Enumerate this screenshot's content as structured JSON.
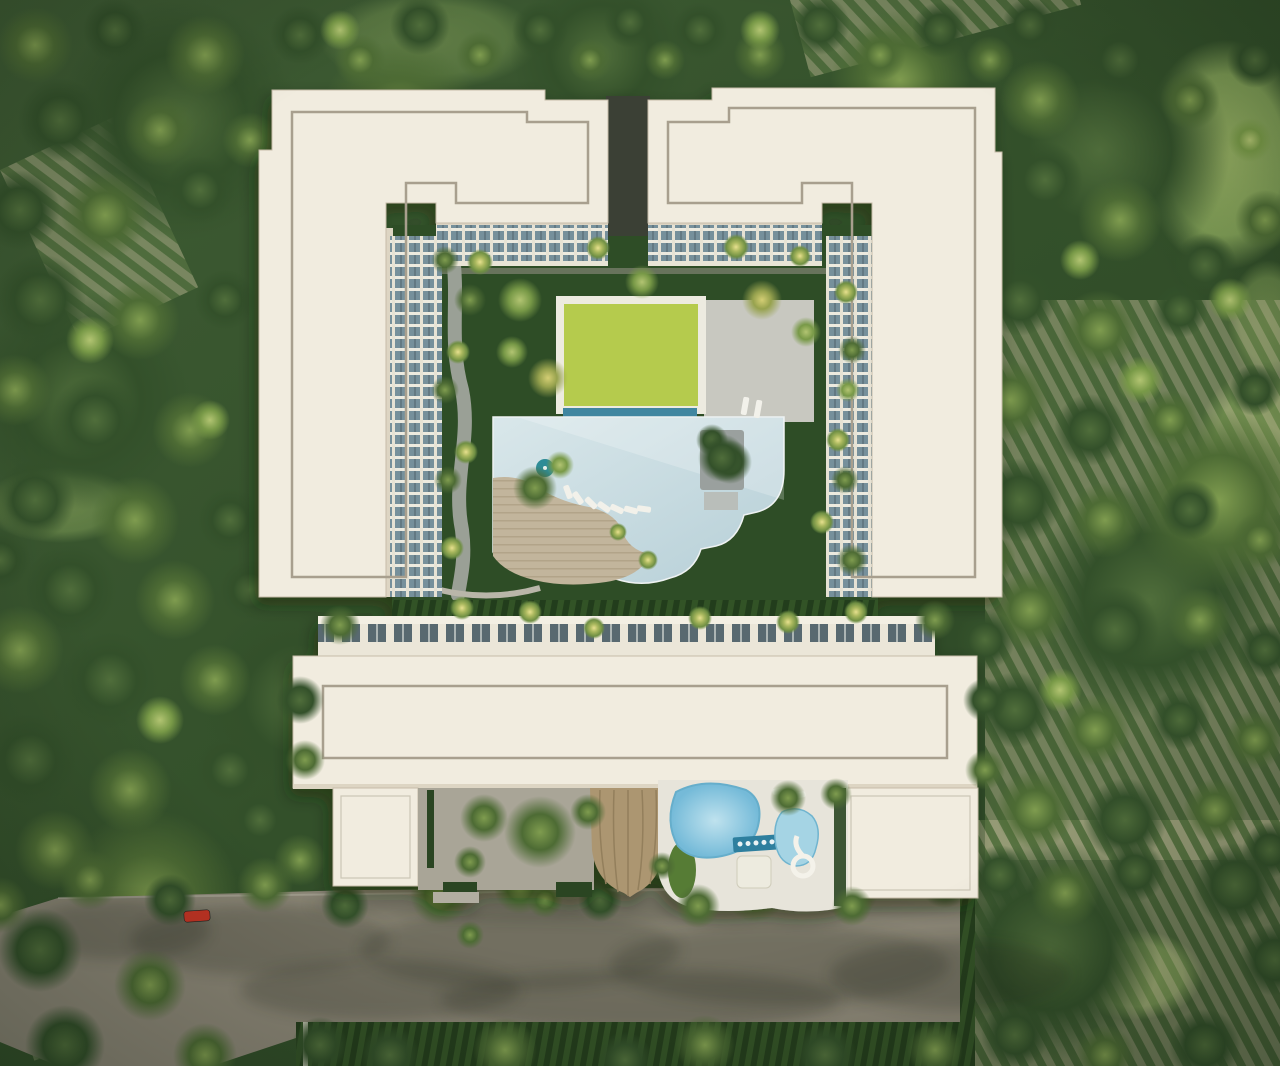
{
  "meta": {
    "description": "Aerial top-down architectural render of a white condominium complex with central courtyard, lap pool, lime lawn, kids pool with slide, parking street with cars, surrounded by dense forest and orchard rows",
    "image_kind": "3d-architectural-render"
  },
  "palette": {
    "forestA": "#3c5832",
    "forestB": "#2b4424",
    "meadow": "#a4bd6b",
    "orchardStripe": "#b7b68f",
    "orchardGreen": "#6d8a4f",
    "road": "#8b8676",
    "curb": "#b5b1a3",
    "hedgeA": "#335226",
    "hedgeB": "#243d1c",
    "hedge": "#2b4522",
    "roof": "#f1ecdf",
    "roofShade": "#ddd5c3",
    "roofLine": "#a89f8e",
    "facadeCream": "#ece7d9",
    "glass": "#76909b",
    "glassDark": "#59696f",
    "lawn": "#2f4e27",
    "lime": "#b5cb4d",
    "limeFrame": "#edebe0",
    "poolA": "#d9e7ea",
    "poolB": "#b6cfd7",
    "poolEdge": "#3f86a0",
    "deck": "#c2b59c",
    "deckDark": "#b2a489",
    "path": "#9aa096",
    "paving": "#a9a597",
    "wall": "#d6d3c6",
    "kidPoolA": "#bfe2ee",
    "kidPoolB": "#74bad8",
    "kidPoolDeep": "#2e7f9e",
    "deckWhite": "#e7e4da",
    "canopyRoof": "#ac9671",
    "canopyRib": "#937f5c",
    "driveway": "#3a3f35",
    "lounger": "#f2f1ea",
    "carWhite": "#ecece8",
    "carDark": "#30363a",
    "carRed": "#c23424",
    "island": "#9aa09e",
    "umbrella": "#2f8c96"
  },
  "scene": {
    "site_label": "condominium-aerial-view",
    "meadows": [
      [
        1225,
        155,
        85,
        115,
        0.85
      ],
      [
        1258,
        448,
        62,
        78,
        0.7
      ],
      [
        1135,
        975,
        68,
        45,
        0.8
      ],
      [
        60,
        505,
        78,
        38,
        0.45
      ],
      [
        1268,
        320,
        40,
        60,
        0.5
      ],
      [
        430,
        40,
        110,
        50,
        0.35
      ]
    ],
    "orchards": [
      [
        985,
        300,
        300,
        560,
        0
      ],
      [
        975,
        820,
        305,
        246,
        0
      ],
      [
        0,
        955,
        190,
        111,
        -18
      ],
      [
        0,
        170,
        130,
        190,
        -25
      ],
      [
        790,
        0,
        280,
        80,
        -15
      ]
    ],
    "road_shadows": [
      [
        260,
        940,
        130,
        35
      ],
      [
        520,
        950,
        160,
        40
      ],
      [
        780,
        965,
        170,
        40
      ],
      [
        120,
        930,
        90,
        30
      ],
      [
        950,
        975,
        120,
        35
      ],
      [
        640,
        1000,
        200,
        30
      ],
      [
        380,
        990,
        140,
        30
      ],
      [
        640,
        905,
        330,
        16
      ]
    ],
    "trees": {
      "bg": [
        [
          180,
          120,
          120,
          "dark"
        ],
        [
          80,
          400,
          110,
          "dark"
        ],
        [
          1100,
          150,
          130,
          "dark"
        ],
        [
          1150,
          600,
          120,
          "dark"
        ],
        [
          300,
          700,
          100,
          "dark"
        ],
        [
          1050,
          950,
          110,
          "dark"
        ],
        [
          600,
          55,
          90,
          "dark"
        ],
        [
          400,
          120,
          80,
          "mid"
        ],
        [
          900,
          80,
          70,
          "mid"
        ],
        [
          1220,
          500,
          90,
          "mid"
        ],
        [
          150,
          900,
          90,
          "mid"
        ],
        [
          35,
          45,
          38,
          "mid"
        ],
        [
          115,
          30,
          32,
          "dark"
        ],
        [
          205,
          55,
          40,
          "mid"
        ],
        [
          60,
          120,
          42,
          "dark"
        ],
        [
          160,
          130,
          36,
          "mid"
        ],
        [
          20,
          210,
          40,
          "dark"
        ],
        [
          105,
          215,
          44,
          "mid"
        ],
        [
          200,
          190,
          34,
          "dark"
        ],
        [
          250,
          140,
          28,
          "mid"
        ],
        [
          40,
          300,
          46,
          "dark"
        ],
        [
          140,
          320,
          40,
          "mid"
        ],
        [
          225,
          300,
          30,
          "dark"
        ],
        [
          15,
          390,
          36,
          "mid"
        ],
        [
          95,
          420,
          44,
          "dark"
        ],
        [
          190,
          430,
          38,
          "mid"
        ],
        [
          35,
          500,
          40,
          "dark"
        ],
        [
          135,
          520,
          44,
          "mid"
        ],
        [
          230,
          520,
          32,
          "dark"
        ],
        [
          70,
          590,
          46,
          "dark"
        ],
        [
          175,
          600,
          40,
          "mid"
        ],
        [
          250,
          590,
          30,
          "dark"
        ],
        [
          20,
          650,
          44,
          "mid"
        ],
        [
          110,
          680,
          48,
          "dark"
        ],
        [
          215,
          680,
          36,
          "mid"
        ],
        [
          30,
          760,
          46,
          "dark"
        ],
        [
          130,
          790,
          42,
          "mid"
        ],
        [
          230,
          770,
          34,
          "dark"
        ],
        [
          55,
          850,
          40,
          "mid"
        ],
        [
          0,
          560,
          30,
          "dark"
        ],
        [
          260,
          820,
          30,
          "dark"
        ],
        [
          300,
          860,
          26,
          "mid"
        ],
        [
          300,
          35,
          30,
          "dark"
        ],
        [
          360,
          60,
          26,
          "mid"
        ],
        [
          420,
          25,
          30,
          "dark"
        ],
        [
          480,
          55,
          24,
          "mid"
        ],
        [
          540,
          30,
          28,
          "dark"
        ],
        [
          590,
          60,
          22,
          "mid"
        ],
        [
          630,
          22,
          26,
          "dark"
        ],
        [
          665,
          60,
          20,
          "mid"
        ],
        [
          700,
          30,
          28,
          "dark"
        ],
        [
          760,
          55,
          26,
          "mid"
        ],
        [
          820,
          25,
          30,
          "dark"
        ],
        [
          880,
          55,
          26,
          "mid"
        ],
        [
          940,
          30,
          28,
          "dark"
        ],
        [
          990,
          60,
          24,
          "mid"
        ],
        [
          1030,
          25,
          28,
          "dark"
        ],
        [
          628,
          120,
          16,
          "dark"
        ],
        [
          628,
          175,
          14,
          "dark"
        ],
        [
          630,
          215,
          12,
          "mid"
        ],
        [
          1040,
          100,
          40,
          "mid"
        ],
        [
          1120,
          60,
          34,
          "dark"
        ],
        [
          1190,
          100,
          30,
          "mid"
        ],
        [
          1255,
          60,
          28,
          "dark"
        ],
        [
          1045,
          180,
          38,
          "dark"
        ],
        [
          1120,
          220,
          42,
          "mid"
        ],
        [
          1205,
          265,
          32,
          "dark"
        ],
        [
          1265,
          220,
          30,
          "mid"
        ],
        [
          1020,
          300,
          36,
          "dark"
        ],
        [
          1100,
          330,
          40,
          "mid"
        ],
        [
          1180,
          310,
          28,
          "dark"
        ],
        [
          1010,
          400,
          40,
          "mid"
        ],
        [
          1090,
          430,
          36,
          "dark"
        ],
        [
          1170,
          420,
          30,
          "mid"
        ],
        [
          1255,
          390,
          26,
          "dark"
        ],
        [
          1020,
          500,
          42,
          "dark"
        ],
        [
          1105,
          520,
          38,
          "mid"
        ],
        [
          1190,
          510,
          30,
          "dark"
        ],
        [
          1260,
          540,
          28,
          "mid"
        ],
        [
          1030,
          610,
          40,
          "mid"
        ],
        [
          1115,
          630,
          44,
          "dark"
        ],
        [
          1200,
          620,
          32,
          "mid"
        ],
        [
          1265,
          650,
          28,
          "dark"
        ],
        [
          1015,
          710,
          38,
          "dark"
        ],
        [
          1095,
          730,
          36,
          "mid"
        ],
        [
          1180,
          720,
          30,
          "dark"
        ],
        [
          1255,
          740,
          30,
          "mid"
        ],
        [
          1035,
          810,
          40,
          "mid"
        ],
        [
          1125,
          820,
          42,
          "dark"
        ],
        [
          1215,
          810,
          32,
          "mid"
        ],
        [
          1270,
          850,
          28,
          "dark"
        ],
        [
          985,
          640,
          30,
          "dark"
        ],
        [
          990,
          560,
          26,
          "mid"
        ],
        [
          90,
          340,
          24,
          "light"
        ],
        [
          210,
          420,
          20,
          "light"
        ],
        [
          1140,
          380,
          24,
          "light"
        ],
        [
          1060,
          690,
          22,
          "light"
        ],
        [
          1230,
          300,
          22,
          "light"
        ],
        [
          160,
          720,
          24,
          "light"
        ],
        [
          340,
          30,
          20,
          "light"
        ],
        [
          760,
          30,
          20,
          "light"
        ],
        [
          1250,
          140,
          22,
          "light"
        ],
        [
          1080,
          260,
          20,
          "light"
        ]
      ],
      "road": [
        [
          90,
          880,
          30,
          "mid"
        ],
        [
          170,
          900,
          26,
          "dark"
        ],
        [
          265,
          885,
          28,
          "mid"
        ],
        [
          345,
          905,
          24,
          "dark"
        ],
        [
          440,
          895,
          30,
          "mid"
        ],
        [
          520,
          888,
          26,
          "mid"
        ],
        [
          600,
          900,
          22,
          "dark"
        ],
        [
          755,
          890,
          32,
          "mid"
        ],
        [
          850,
          892,
          28,
          "mid"
        ],
        [
          945,
          882,
          26,
          "dark"
        ],
        [
          1000,
          875,
          30,
          "dark"
        ],
        [
          1065,
          893,
          34,
          "mid"
        ],
        [
          1135,
          872,
          30,
          "dark"
        ],
        [
          1235,
          885,
          42,
          "dark"
        ],
        [
          1275,
          960,
          36,
          "dark"
        ],
        [
          40,
          950,
          42,
          "dark"
        ],
        [
          150,
          985,
          36,
          "mid"
        ],
        [
          65,
          1045,
          40,
          "dark"
        ],
        [
          205,
          1055,
          32,
          "mid"
        ],
        [
          320,
          1045,
          28,
          "dark"
        ],
        [
          0,
          905,
          28,
          "mid"
        ],
        [
          390,
          1055,
          30,
          "dark"
        ],
        [
          505,
          1050,
          32,
          "mid"
        ],
        [
          625,
          1060,
          28,
          "dark"
        ],
        [
          705,
          1045,
          30,
          "mid"
        ],
        [
          825,
          1055,
          32,
          "dark"
        ],
        [
          935,
          1050,
          28,
          "mid"
        ],
        [
          1015,
          1035,
          34,
          "dark"
        ],
        [
          1105,
          1055,
          30,
          "mid"
        ],
        [
          1205,
          1045,
          36,
          "dark"
        ],
        [
          470,
          935,
          14,
          "mid"
        ],
        [
          545,
          900,
          18,
          "mid"
        ]
      ],
      "fg": [
        [
          480,
          262,
          13,
          "palm"
        ],
        [
          598,
          248,
          12,
          "palm"
        ],
        [
          736,
          247,
          13,
          "palm"
        ],
        [
          800,
          256,
          11,
          "palm"
        ],
        [
          846,
          292,
          12,
          "palm"
        ],
        [
          458,
          352,
          12,
          "palm"
        ],
        [
          466,
          452,
          12,
          "palm"
        ],
        [
          452,
          548,
          12,
          "palm"
        ],
        [
          462,
          608,
          12,
          "palm"
        ],
        [
          530,
          612,
          12,
          "palm"
        ],
        [
          594,
          628,
          11,
          "palm"
        ],
        [
          700,
          618,
          12,
          "palm"
        ],
        [
          788,
          622,
          12,
          "palm"
        ],
        [
          856,
          612,
          12,
          "palm"
        ],
        [
          838,
          440,
          12,
          "palm"
        ],
        [
          822,
          522,
          12,
          "palm"
        ],
        [
          648,
          560,
          10,
          "palm"
        ],
        [
          618,
          532,
          9,
          "palm"
        ],
        [
          520,
          300,
          22,
          "light"
        ],
        [
          548,
          378,
          20,
          "yellow"
        ],
        [
          512,
          352,
          16,
          "light"
        ],
        [
          642,
          282,
          17,
          "light"
        ],
        [
          762,
          300,
          20,
          "yellow"
        ],
        [
          806,
          332,
          15,
          "light"
        ],
        [
          730,
          462,
          22,
          "dark"
        ],
        [
          535,
          488,
          22,
          "mid"
        ],
        [
          560,
          465,
          14,
          "light"
        ],
        [
          470,
          300,
          16,
          "mid"
        ],
        [
          445,
          390,
          14,
          "mid"
        ],
        [
          448,
          480,
          14,
          "mid"
        ],
        [
          445,
          260,
          14,
          "mid"
        ],
        [
          852,
          350,
          14,
          "mid"
        ],
        [
          848,
          390,
          12,
          "light"
        ],
        [
          845,
          480,
          14,
          "mid"
        ],
        [
          852,
          560,
          16,
          "mid"
        ],
        [
          712,
          440,
          16,
          "dark"
        ],
        [
          722,
          458,
          24,
          "dark"
        ],
        [
          540,
          832,
          36,
          "mid"
        ],
        [
          484,
          818,
          24,
          "mid"
        ],
        [
          588,
          812,
          18,
          "mid"
        ],
        [
          470,
          862,
          16,
          "mid"
        ],
        [
          698,
          906,
          22,
          "mid"
        ],
        [
          788,
          798,
          18,
          "mid"
        ],
        [
          836,
          794,
          16,
          "mid"
        ],
        [
          662,
          866,
          14,
          "mid"
        ],
        [
          852,
          906,
          20,
          "mid"
        ],
        [
          300,
          700,
          24,
          "dark"
        ],
        [
          305,
          760,
          20,
          "mid"
        ],
        [
          985,
          700,
          22,
          "dark"
        ],
        [
          985,
          770,
          20,
          "mid"
        ],
        [
          340,
          625,
          20,
          "mid"
        ],
        [
          935,
          620,
          20,
          "mid"
        ]
      ]
    },
    "loungers": [
      [
        568,
        492,
        -20,
        14
      ],
      [
        578,
        498,
        -35,
        14
      ],
      [
        591,
        503,
        -45,
        14
      ],
      [
        604,
        507,
        -55,
        14
      ],
      [
        617,
        509,
        -65,
        14
      ],
      [
        631,
        510,
        -75,
        14
      ],
      [
        644,
        509,
        -82,
        14
      ],
      [
        745,
        406,
        10,
        18
      ],
      [
        758,
        409,
        10,
        18
      ],
      [
        779,
        791,
        80,
        13
      ],
      [
        789,
        793,
        80,
        13
      ],
      [
        799,
        795,
        80,
        13
      ]
    ],
    "cars": [
      {
        "x": 197,
        "y": 916,
        "w": 26,
        "h": 11,
        "rot": -4,
        "color": "carRed"
      },
      {
        "x": 57,
        "y": 974,
        "w": 24,
        "h": 11,
        "rot": 3,
        "color": "carWhite"
      },
      {
        "x": 352,
        "y": 991,
        "w": 24,
        "h": 11,
        "rot": -2,
        "color": "carWhite"
      },
      {
        "x": 248,
        "y": 1032,
        "w": 11,
        "h": 24,
        "rot": 0,
        "color": "carWhite"
      },
      {
        "x": 640,
        "y": 937,
        "w": 24,
        "h": 11,
        "rot": 2,
        "color": "carDark"
      },
      {
        "x": 868,
        "y": 1003,
        "w": 24,
        "h": 11,
        "rot": -3,
        "color": "carDark"
      }
    ]
  }
}
